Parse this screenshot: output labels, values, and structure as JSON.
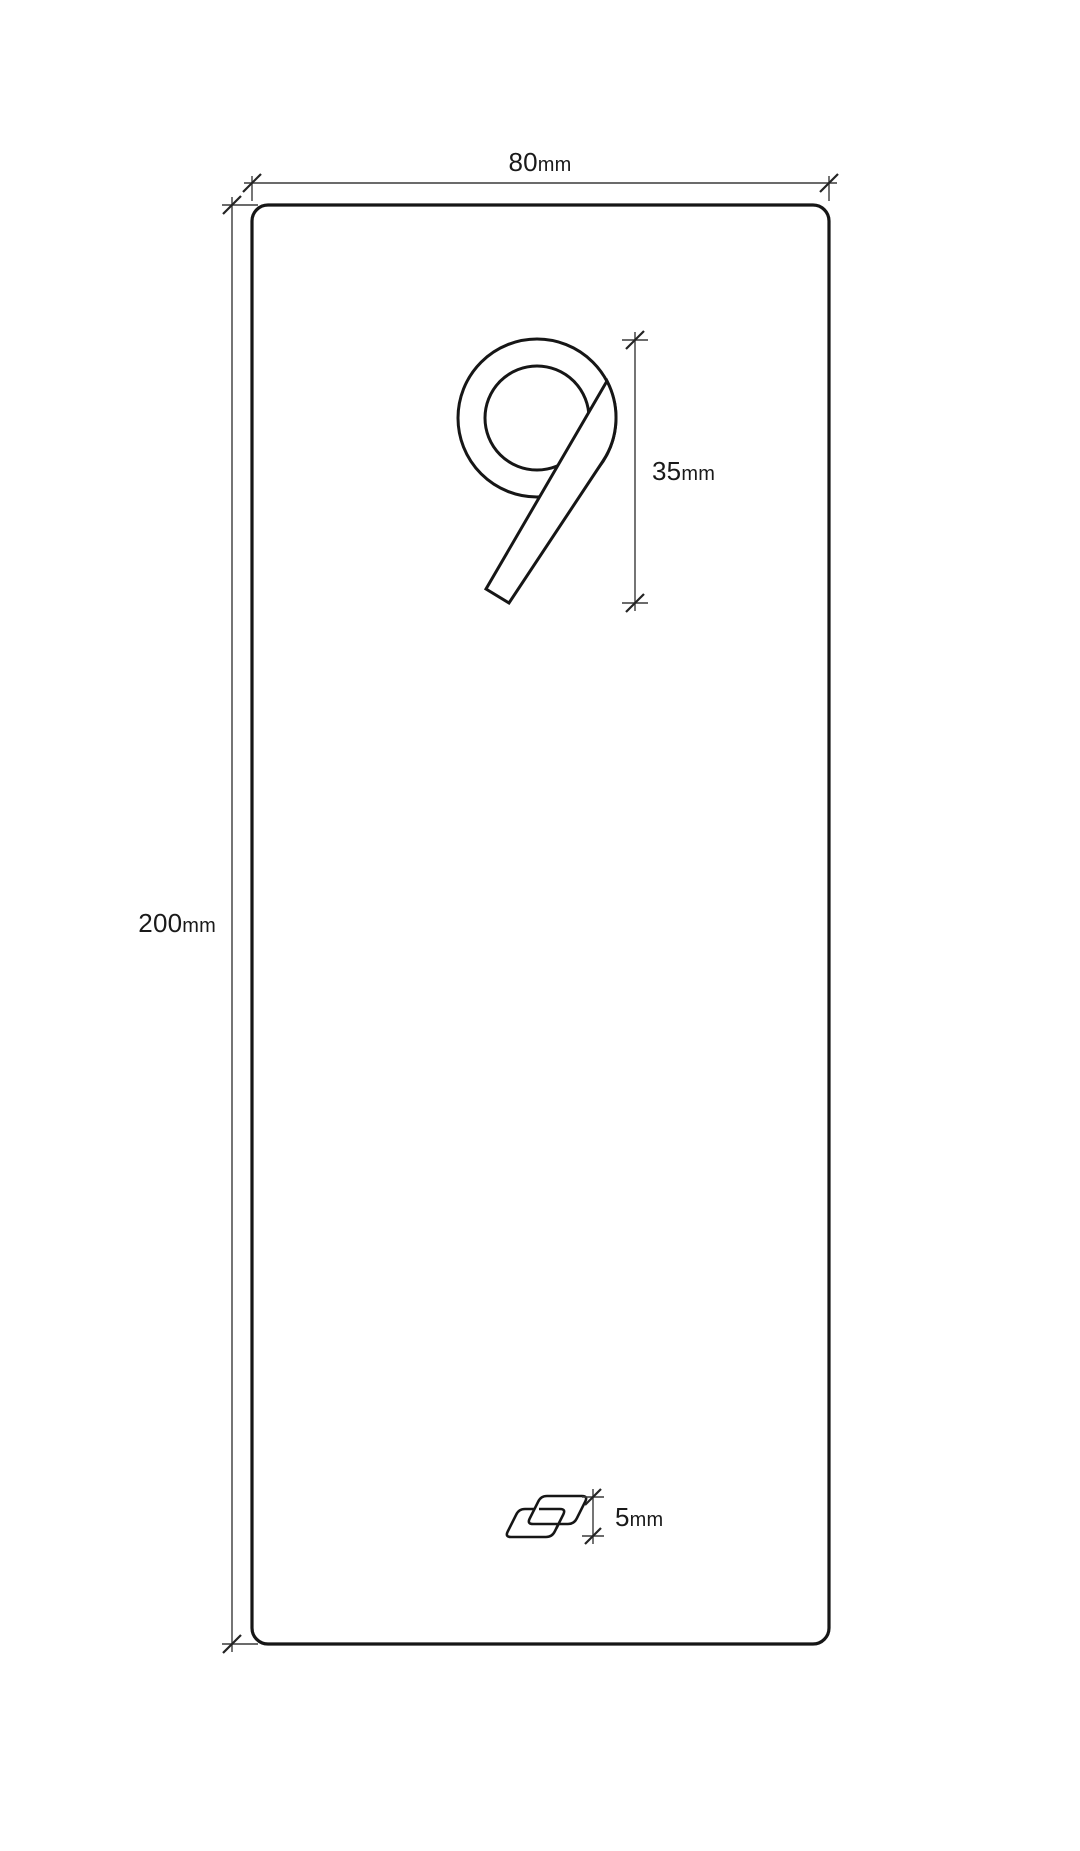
{
  "page": {
    "background": "#ffffff"
  },
  "drawing": {
    "ink_color": "#161616",
    "dim_line_color": "#3a3a3a",
    "tick_color": "#242424",
    "label_color": "#1a1a1a",
    "plate": {
      "shape": "rounded-rectangle-plate",
      "width": {
        "value": "80",
        "unit": "mm"
      },
      "height": {
        "value": "200",
        "unit": "mm"
      }
    },
    "digit": {
      "glyph": "9",
      "height": {
        "value": "35",
        "unit": "mm"
      }
    },
    "logo": {
      "icon": "interlocked-parallelograms-logo",
      "height": {
        "value": "5",
        "unit": "mm"
      }
    }
  }
}
